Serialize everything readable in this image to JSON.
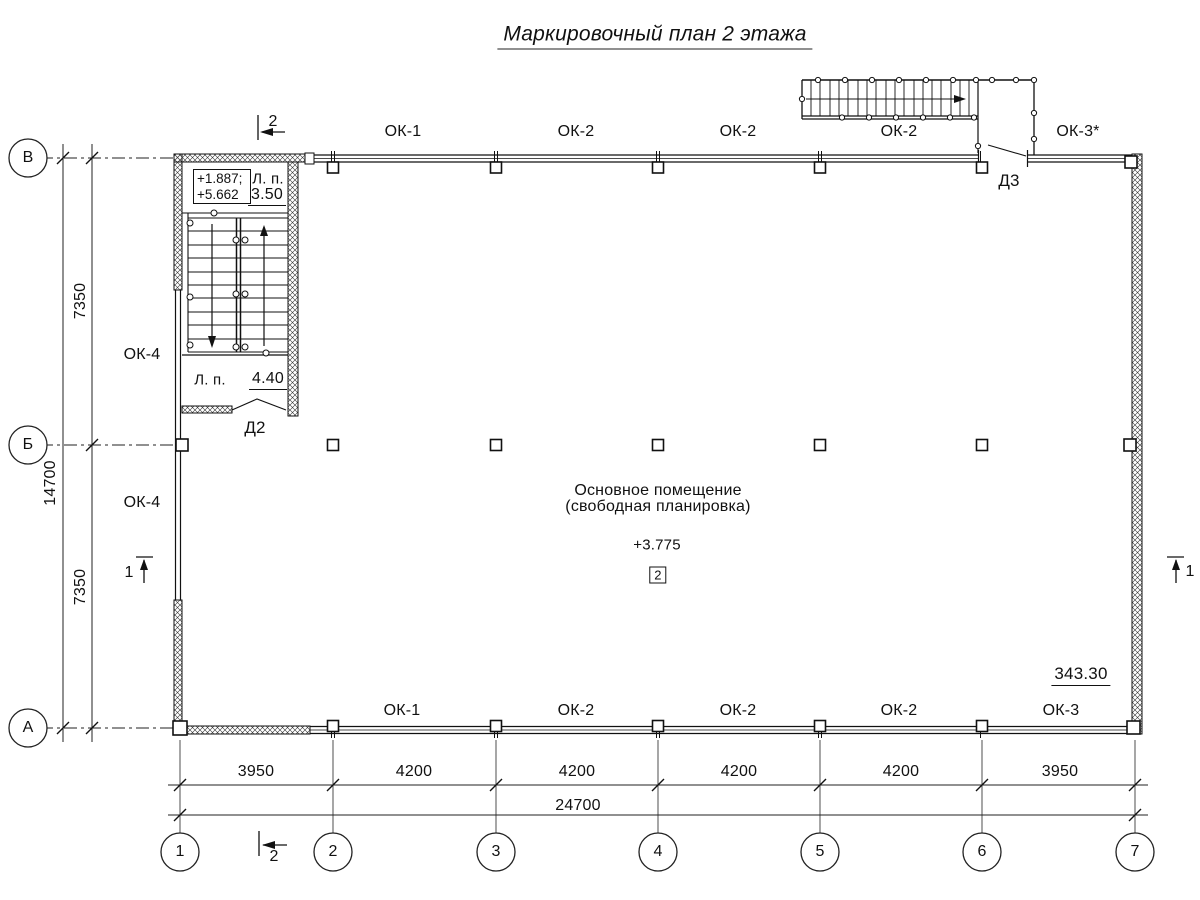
{
  "title": "Маркировочный план 2 этажа",
  "axes": {
    "cols": [
      "1",
      "2",
      "3",
      "4",
      "5",
      "6",
      "7"
    ],
    "rows": [
      "В",
      "Б",
      "А"
    ]
  },
  "dims": {
    "bottom": [
      "3950",
      "4200",
      "4200",
      "4200",
      "4200",
      "3950"
    ],
    "bottom_total": "24700",
    "left": [
      "7350",
      "7350"
    ],
    "left_total": "14700"
  },
  "windows": {
    "top": [
      "ОК-1",
      "ОК-2",
      "ОК-2",
      "ОК-2",
      "ОК-3*"
    ],
    "bottom": [
      "ОК-1",
      "ОК-2",
      "ОК-2",
      "ОК-2",
      "ОК-3"
    ],
    "left": [
      "ОК-4",
      "ОК-4"
    ]
  },
  "doors": {
    "d2": "Д2",
    "d3": "Д3"
  },
  "stairwell": {
    "elev1": "+1.887;",
    "elev2": "+5.662",
    "label_upper": "Л. п.",
    "area_upper": "3.50",
    "label_lower": "Л. п.",
    "area_lower": "4.40"
  },
  "room": {
    "line1": "Основное помещение",
    "line2": "(свободная планировка)",
    "elevation": "+3.775",
    "number": "2"
  },
  "annotations": {
    "area_total": "343.30"
  },
  "sections": {
    "s1": "1",
    "s2": "2"
  }
}
